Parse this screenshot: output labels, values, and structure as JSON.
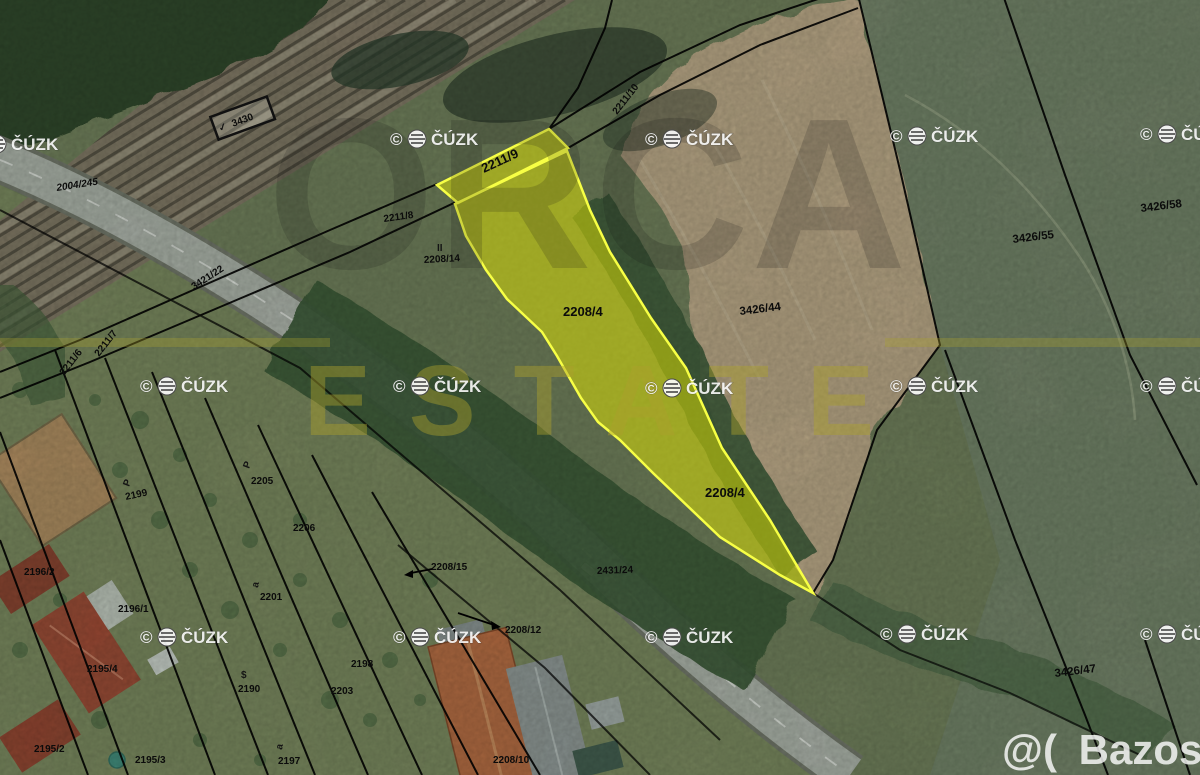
{
  "map": {
    "highlight_color": "#e6e600",
    "boundary_color": "#000000",
    "parcel_labels": [
      {
        "text": "2004/245"
      },
      {
        "text": "3421/22"
      },
      {
        "text": "3430"
      },
      {
        "text": "2211/9"
      },
      {
        "text": "2211/10"
      },
      {
        "text": "2211/8"
      },
      {
        "text": "2208/14"
      },
      {
        "text": "2208/4"
      },
      {
        "text": "2208/4"
      },
      {
        "text": "3426/44"
      },
      {
        "text": "3426/55"
      },
      {
        "text": "3426/58"
      },
      {
        "text": "3426/47"
      },
      {
        "text": "2205"
      },
      {
        "text": "2206"
      },
      {
        "text": "2201"
      },
      {
        "text": "2199"
      },
      {
        "text": "2190"
      },
      {
        "text": "2196/2"
      },
      {
        "text": "2196/1"
      },
      {
        "text": "2195/4"
      },
      {
        "text": "2195/2"
      },
      {
        "text": "2195/3"
      },
      {
        "text": "2197"
      },
      {
        "text": "2198"
      },
      {
        "text": "2203"
      },
      {
        "text": "2208/12"
      },
      {
        "text": "2208/15"
      },
      {
        "text": "2208/10"
      },
      {
        "text": "2431/24"
      },
      {
        "text": "2211/6"
      },
      {
        "text": "2211/7"
      }
    ],
    "symbols": [
      {
        "char": "P"
      },
      {
        "char": "P"
      },
      {
        "char": "a"
      },
      {
        "char": "a"
      },
      {
        "char": "$"
      },
      {
        "char": "✓"
      },
      {
        "char": "II"
      }
    ],
    "cuzk_watermark": {
      "copyright": "©",
      "org": "ČÚZK"
    },
    "agency_watermark": {
      "line1": "ORCA",
      "line2": "ESTATE"
    },
    "site_watermark": {
      "logo": "@(",
      "name": "Bazos.cz"
    }
  }
}
